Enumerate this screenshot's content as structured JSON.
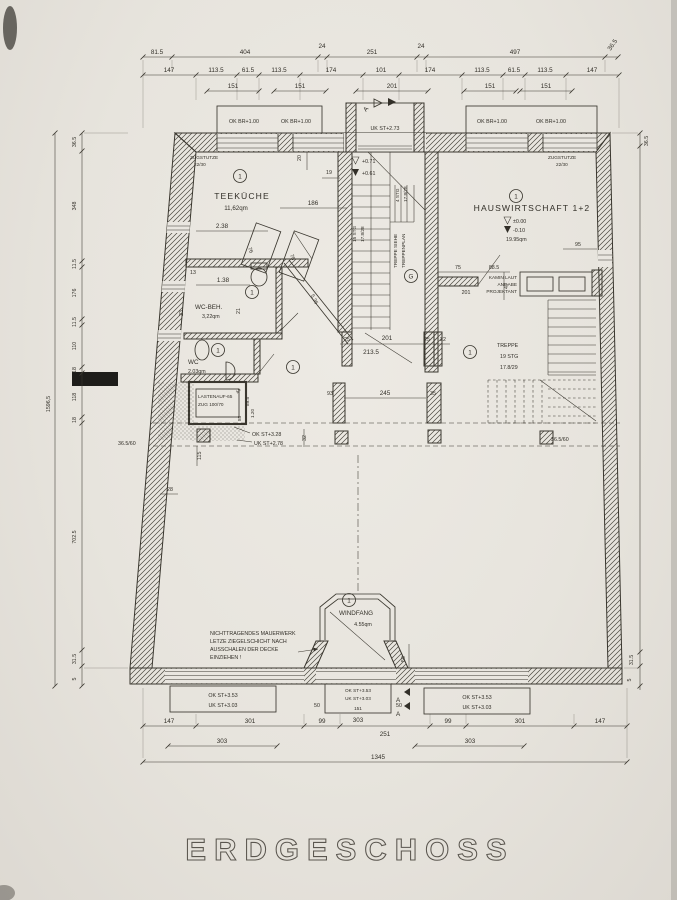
{
  "title": "ERDGESCHOSS",
  "tags": {
    "room": "1",
    "stair_hall": "G"
  },
  "rooms": {
    "teekueche": {
      "name": "TEEKÜCHE",
      "area": "11,62qm"
    },
    "hauswirtschaft": {
      "name": "HAUSWIRTSCHAFT 1+2",
      "level_ok": "±0.00",
      "level_uk": "-0.10",
      "area": "19.95qm"
    },
    "wc_beh": {
      "name": "WC-BEH.",
      "area": "3,22qm"
    },
    "wc": {
      "name": "WC",
      "area": "2.03qm"
    },
    "windfang": {
      "name": "WINDFANG",
      "area": "4.55qm"
    },
    "lastenaufzug": {
      "line1": "LASTENAUF-65",
      "line2": "ZUG 100/70"
    }
  },
  "stairs": {
    "hall": {
      "note_l1": "TREPPE SIEHE",
      "note_l2": "TREPPENPLAN",
      "f1a": "15 STG",
      "f1b": "17.8/28",
      "f2a": "4 STG",
      "f2b": "17.8/28"
    },
    "right": {
      "l1": "TREPPE",
      "l2": "19 STG",
      "l3": "17.8/29"
    }
  },
  "levels": {
    "hall_upper": "+0.71",
    "hall_lower": "+0.61",
    "entry": "UK ST+2.73",
    "window_sill": "OK BR+1.00",
    "mid_ok": "OK ST+3.28",
    "mid_uk": "UK ST+2.78",
    "bottom_ok": "OK ST+3.53",
    "bottom_uk": "UK ST+3.03"
  },
  "notes": {
    "zugstuetze_l1": "ZUGSTUTZE",
    "zugstuetze_l2": "22/30",
    "kamin_l1": "KAMIN LAUT",
    "kamin_l2": "ANGABE",
    "kamin_l3": "PROJEKTANT",
    "mauerwerk_l1": "NICHTTRAGENDES MAUERWERK",
    "mauerwerk_l2": "LETZE ZIEGELSCHICHT NACH",
    "mauerwerk_l3": "AUSSCHALEN DER DECKE",
    "mauerwerk_l4": "EINZIEHEN !",
    "wall_spec": "36.5/60",
    "section_letter": "A"
  },
  "dims": {
    "top1": [
      "81.5",
      "404",
      "24",
      "251",
      "24",
      "497",
      "36.5"
    ],
    "top2": [
      "147",
      "113.5",
      "61.5",
      "113.5",
      "174",
      "101",
      "174",
      "113.5",
      "61.5",
      "113.5",
      "147"
    ],
    "top3": [
      "151",
      "151",
      "201",
      "151",
      "151"
    ],
    "bottom_door": [
      "50",
      "151",
      "50"
    ],
    "bottom_mid": "303",
    "bottom2": [
      "147",
      "301",
      "99",
      "251",
      "99",
      "301",
      "147"
    ],
    "bottom3": [
      "303",
      "303"
    ],
    "bottom_total": "1345",
    "left": [
      "36.5",
      "348",
      "11.5",
      "176",
      "11.5",
      "110",
      "18",
      "118",
      "18",
      "702.5",
      "31.5",
      "5"
    ],
    "left_total": "1596,5",
    "right_top": "36.5",
    "right_b1": "31.5",
    "right_b2": "5",
    "inner": {
      "a20": "20",
      "a19": "19",
      "a186": "186",
      "a238": "2.38",
      "a76": "76",
      "a78": "78",
      "a13": "13",
      "a138": "1.38",
      "a23": "23",
      "a21": "21",
      "a536": "5.36",
      "b25a": "25",
      "b201": "201",
      "b25b": "25",
      "b22": "22",
      "b2135": "213.5",
      "c245": "245",
      "c35": "35",
      "c93": "93",
      "c115": "115",
      "c28": "28",
      "c32": "32",
      "h75": "75",
      "h201": "201",
      "h885": "88.5",
      "h47": "47",
      "h95": "95",
      "e44": "44",
      "e895": "89.5",
      "e85": "85",
      "e120": "1.20",
      "w50": "50"
    }
  }
}
